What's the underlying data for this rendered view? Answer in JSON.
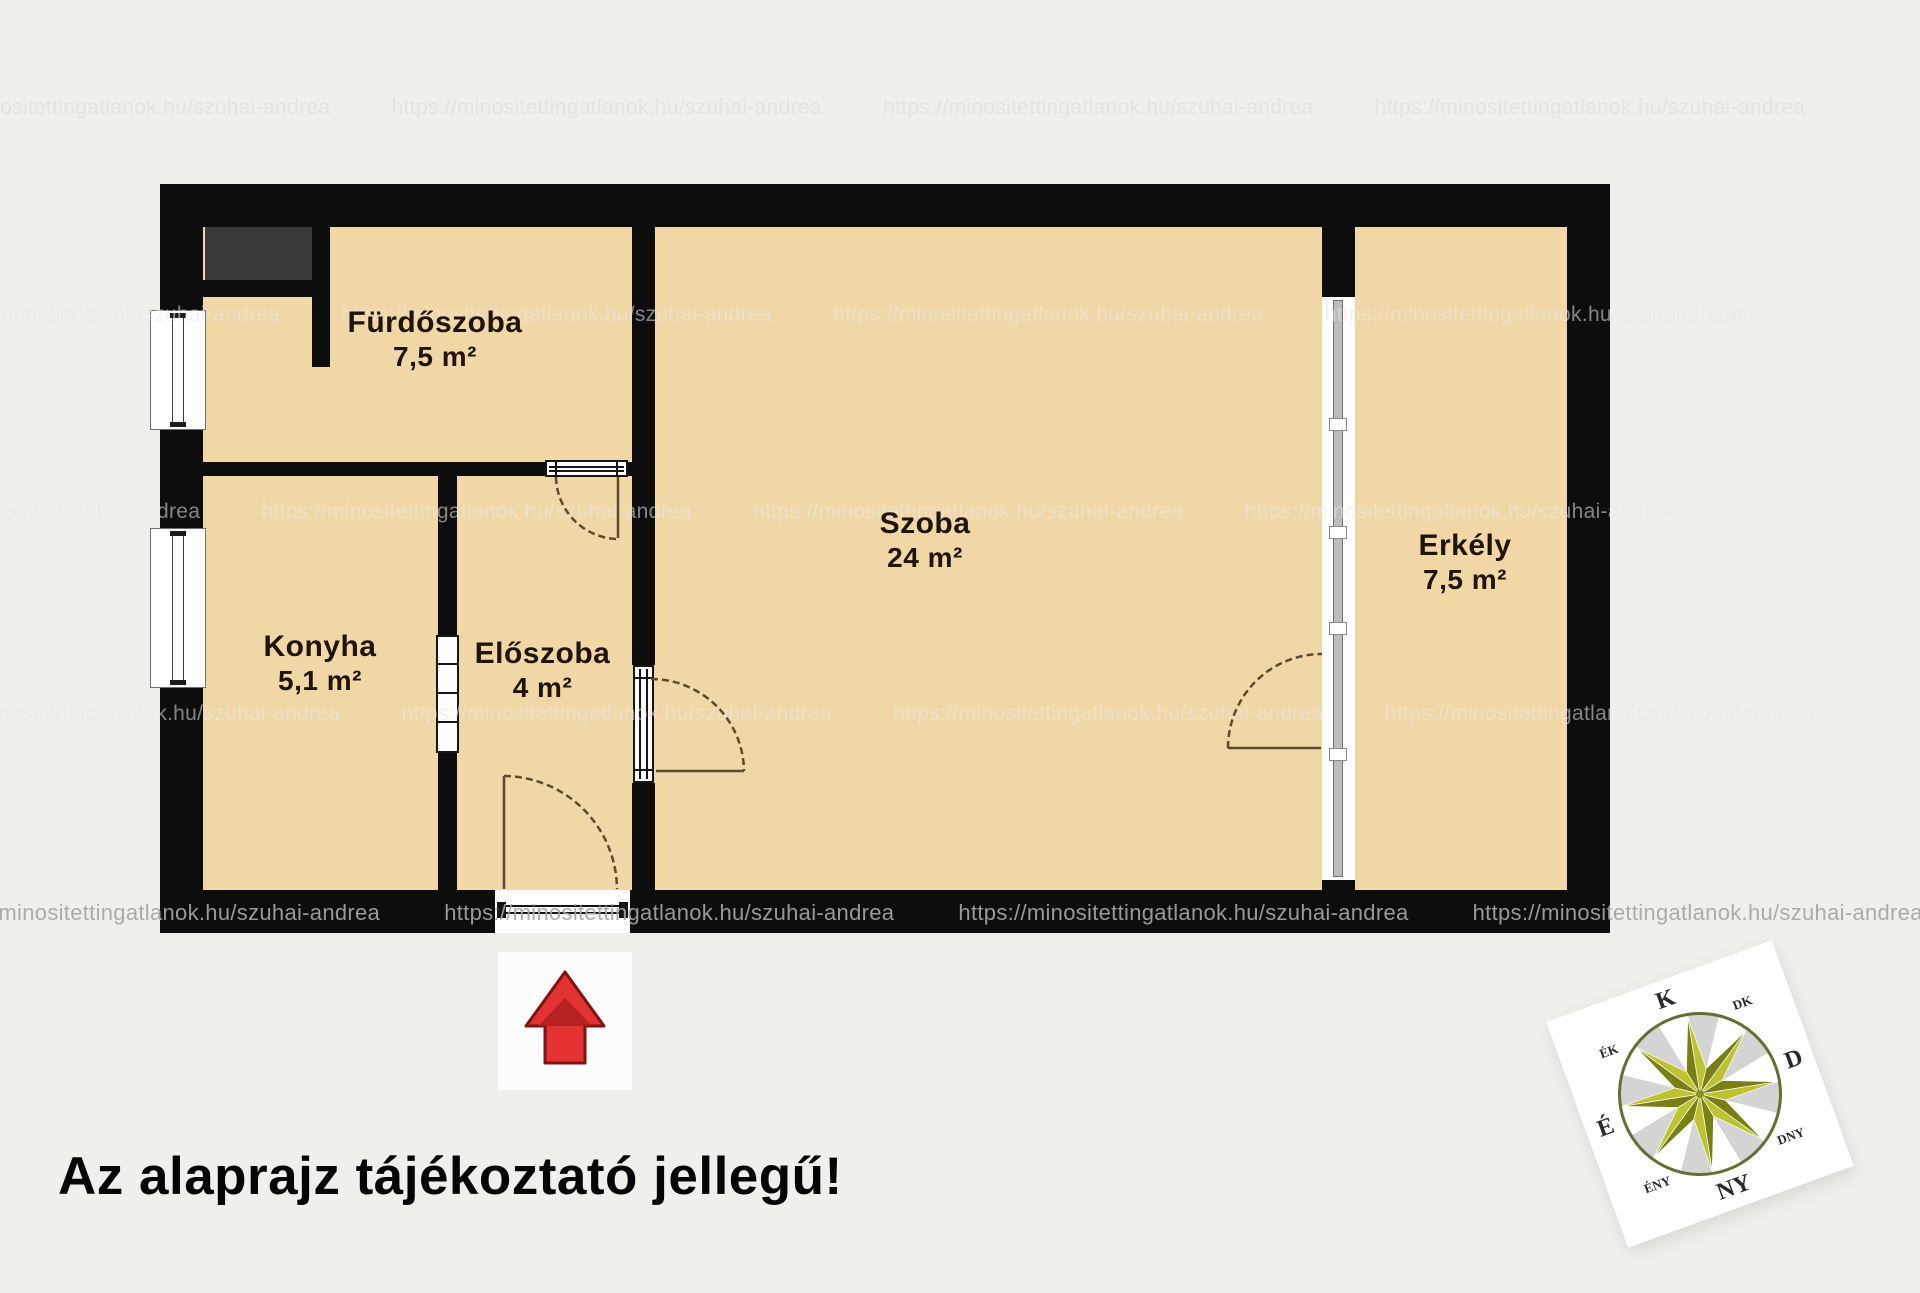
{
  "disclaimer": "Az alaprajz tájékoztató jellegű!",
  "watermark_url": "https://minositettingatlanok.hu/szuhai-andrea",
  "rooms": [
    {
      "name": "Fürdőszoba",
      "area": "7,5 m²"
    },
    {
      "name": "Konyha",
      "area": "5,1 m²"
    },
    {
      "name": "Előszoba",
      "area": "4 m²"
    },
    {
      "name": "Szoba",
      "area": "24 m²"
    },
    {
      "name": "Erkély",
      "area": "7,5 m²"
    }
  ],
  "compass": {
    "labels": [
      "K",
      "DK",
      "D",
      "DNY",
      "NY",
      "ÉNY",
      "É",
      "ÉK"
    ]
  },
  "colors": {
    "background": "#f0efeb",
    "floor": "#f2d7a6",
    "wall": "#0d0d0d",
    "shaft_gray": "#3a3a3a",
    "arrow_red": "#e43131",
    "arrow_dark_red": "#7e1414",
    "star_light": "#bcc32f",
    "star_dark": "#787f15",
    "door_line": "#5b4a30"
  }
}
